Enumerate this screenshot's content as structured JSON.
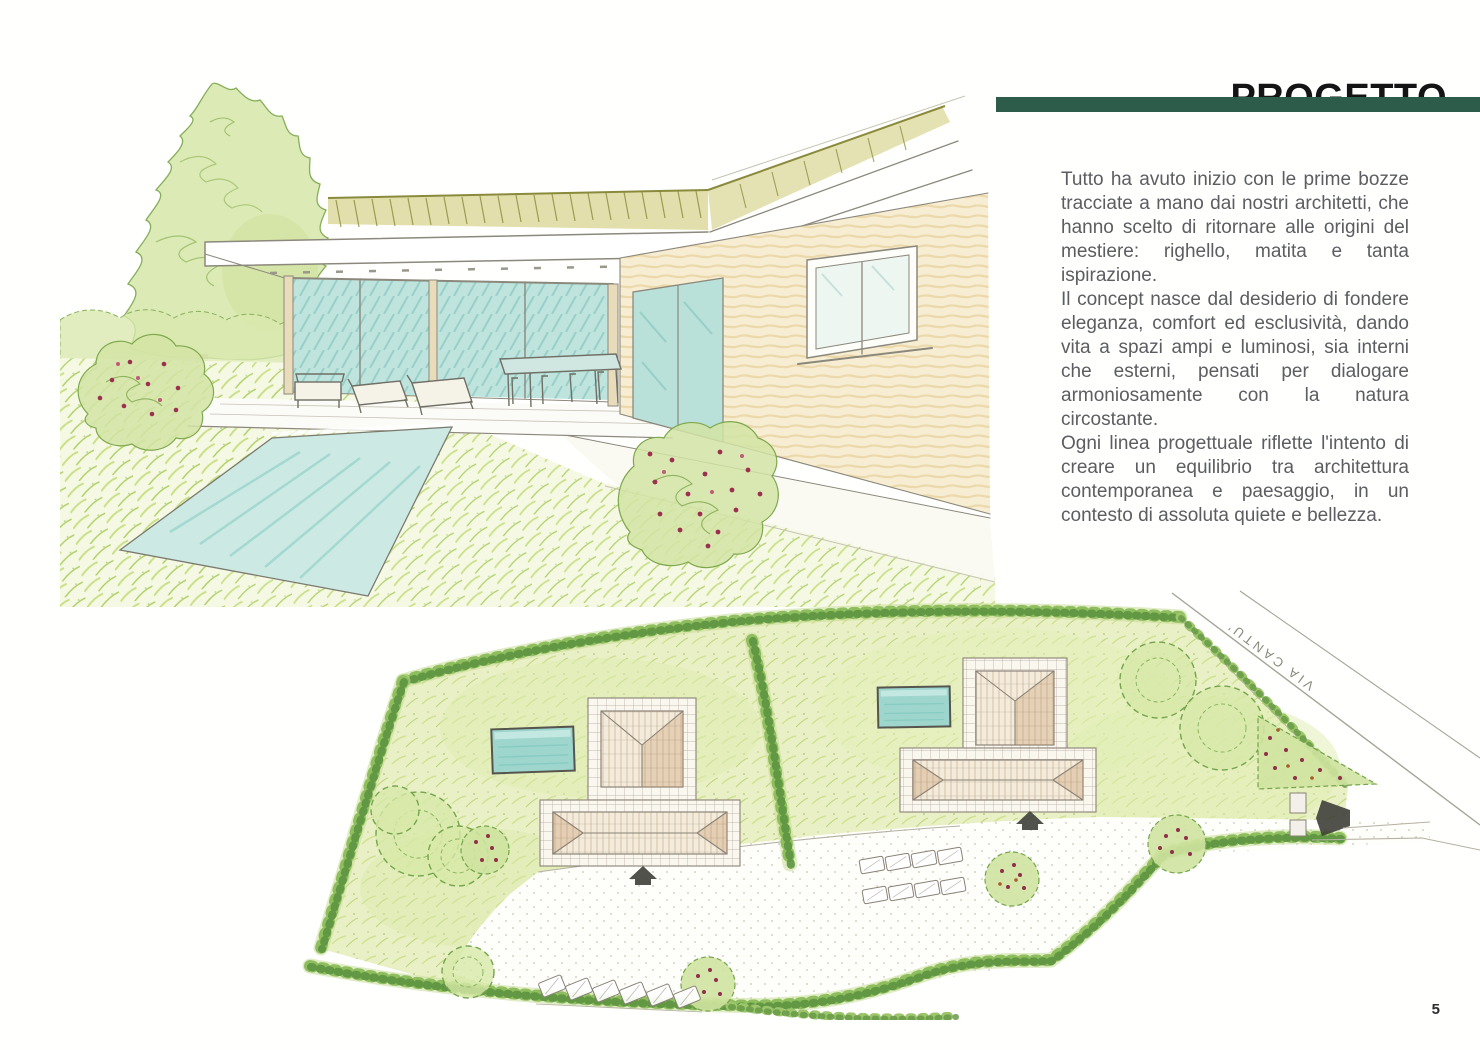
{
  "header": {
    "title": "PROGETTO",
    "accent_color": "#2e5c4b"
  },
  "article": {
    "text_color": "#5b5d60",
    "paragraphs": [
      "Tutto ha avuto inizio con le prime bozze tracciate a mano dai nostri architetti, che hanno scelto di ritornare alle origini del mestiere: righello, matita e tanta ispirazione.",
      "Il concept nasce dal desiderio di fondere eleganza, comfort ed esclusività, dando vita a spazi ampi e luminosi, sia interni che esterni, pensati per dialogare armoniosamente con la natura circostante.",
      "Ogni linea progettuale riflette l'intento di creare un equilibrio tra architettura contemporanea e paesaggio, in un contesto di assoluta quiete e bellezza."
    ]
  },
  "site_plan": {
    "road_label": "VIA CANTU'"
  },
  "footer": {
    "page_number": "5"
  },
  "palette": {
    "pencil": "#8b887c",
    "lawn_green": "#cde08b",
    "hedge_green": "#5d9440",
    "pool_teal": "#9ed6cd",
    "roof_olive": "#8f8f3f",
    "flower_red": "#8f2f4a"
  }
}
